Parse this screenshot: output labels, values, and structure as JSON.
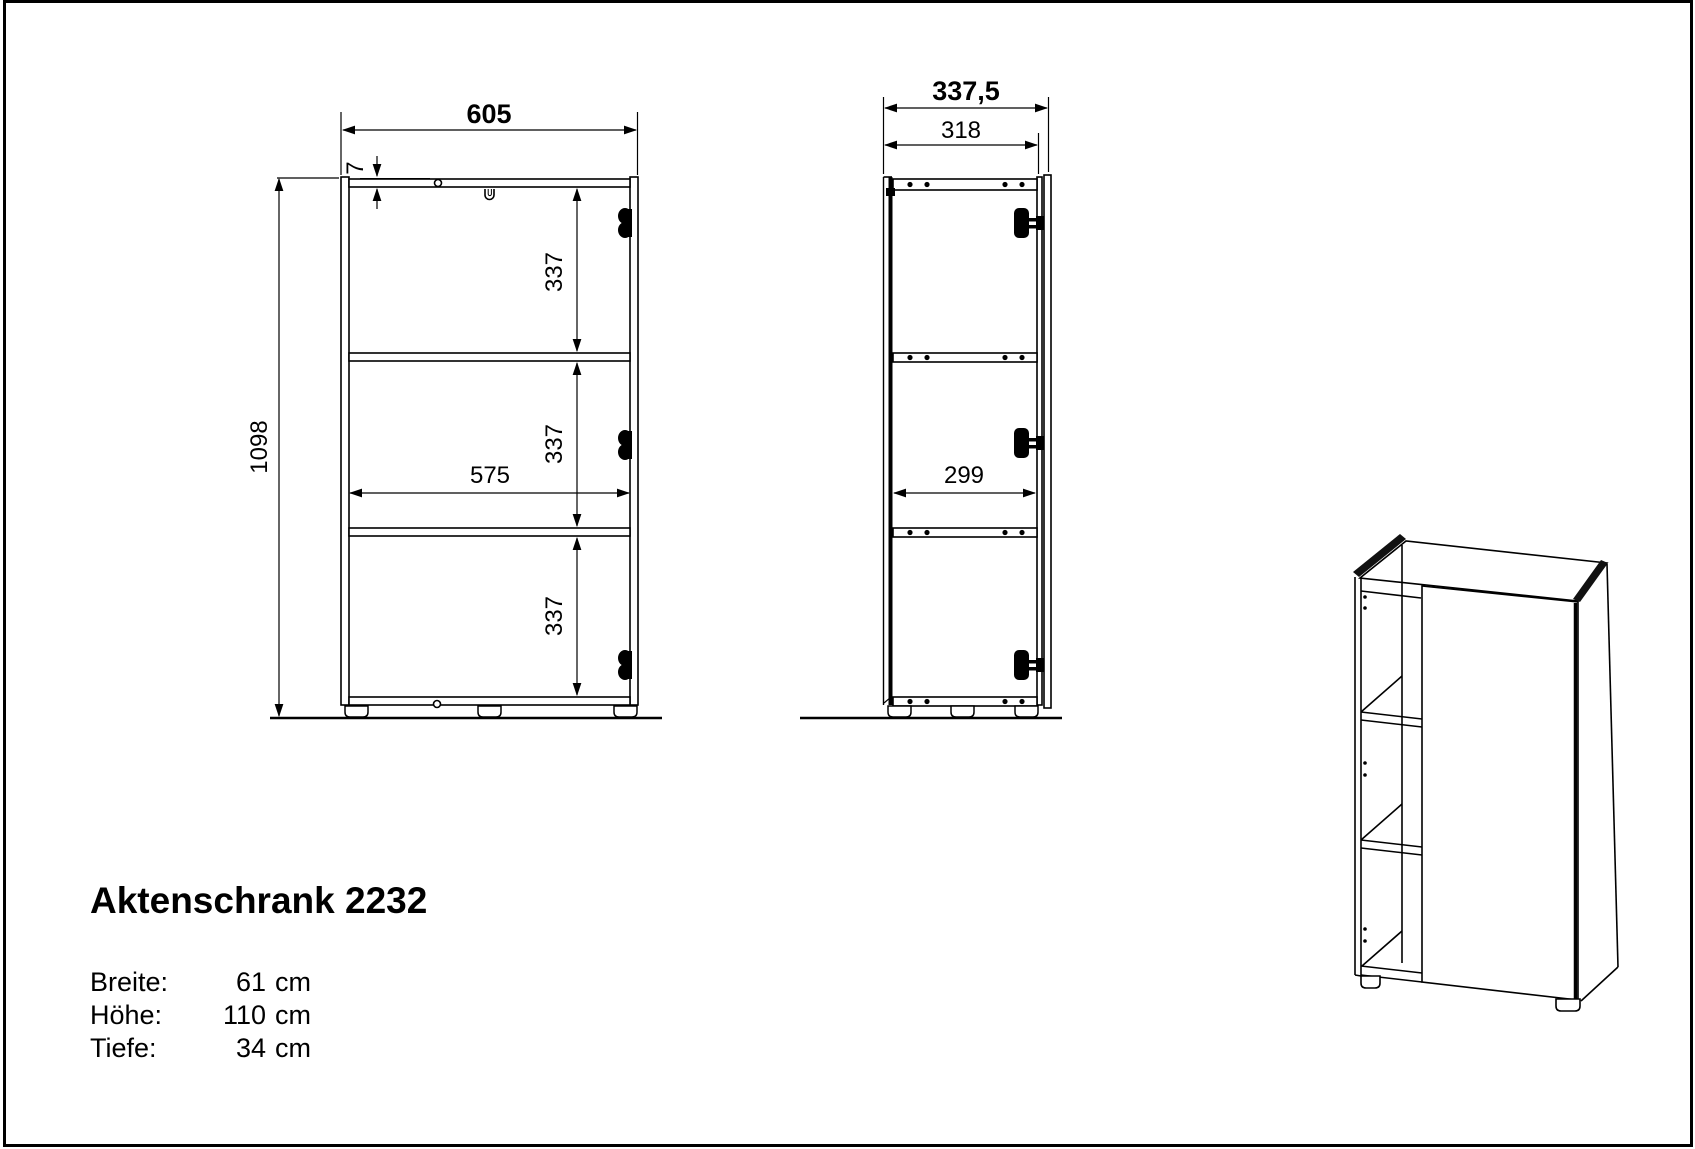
{
  "title": "Aktenschrank 2232",
  "specs": [
    {
      "label": "Breite:",
      "value": "61",
      "unit": "cm"
    },
    {
      "label": "Höhe:",
      "value": "110",
      "unit": "cm"
    },
    {
      "label": "Tiefe:",
      "value": "34",
      "unit": "cm"
    }
  ],
  "front_view": {
    "total_width": "605",
    "total_height": "1098",
    "top_panel_thickness": "7",
    "inner_width": "575",
    "sections": [
      "337",
      "337",
      "337"
    ]
  },
  "side_view": {
    "total_depth": "337,5",
    "carcass_depth": "318",
    "inner_depth": "299"
  },
  "colors": {
    "line": "#000000",
    "background": "#ffffff"
  }
}
